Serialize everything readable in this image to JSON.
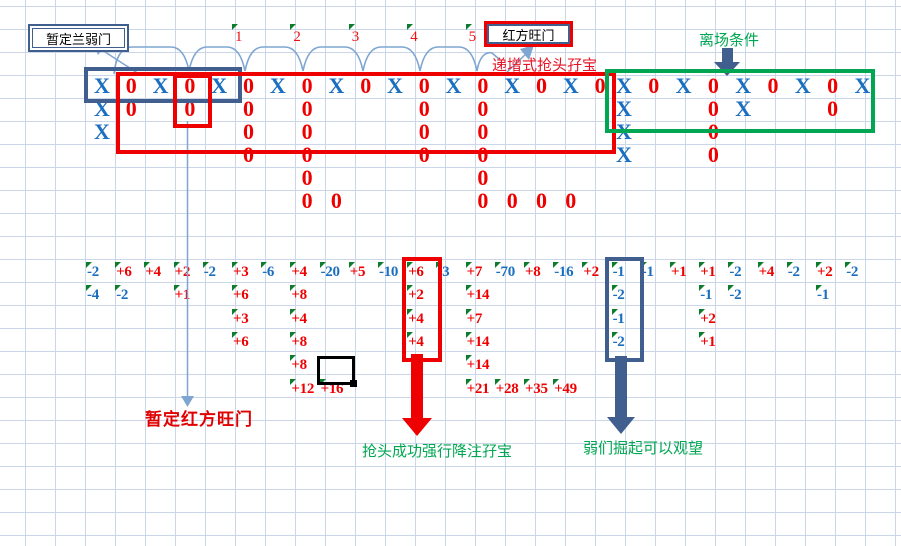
{
  "labels": {
    "weak_door": "暂定兰弱门",
    "strong_door": "红方旺门",
    "incremental_double": "递增式抢头孖宝",
    "exit_condition": "离场条件",
    "tentative_strong": "暂定红方旺门",
    "grab_success": "抢头成功强行降注孖宝",
    "weak_rise": "弱们掘起可以观望"
  },
  "header_numbers": [
    {
      "label": "1",
      "col": 5
    },
    {
      "label": "2",
      "col": 7
    },
    {
      "label": "3",
      "col": 9
    },
    {
      "label": "4",
      "col": 11
    },
    {
      "label": "5",
      "col": 13
    }
  ],
  "colors": {
    "x_blue": "#1b6fc0",
    "o_red": "#ef0000",
    "positive_red": "#ef0000",
    "negative_blue": "#1b6fc0",
    "navy_shape": "#415f8e",
    "green_shape": "#00a651",
    "comment_triangle_green": "#0d7d2d",
    "annotation_dark_red": "#e00000",
    "grid_line": "#cbd6e8",
    "thin_line_blue": "#7fa5d1",
    "box_red": "#ef0000",
    "selection_black": "#000000"
  },
  "left_grid_marks": [
    [
      0,
      0,
      "X"
    ],
    [
      0,
      1,
      "0"
    ],
    [
      0,
      2,
      "X"
    ],
    [
      0,
      3,
      "0"
    ],
    [
      0,
      4,
      "X"
    ],
    [
      0,
      5,
      "0"
    ],
    [
      0,
      6,
      "X"
    ],
    [
      0,
      7,
      "0"
    ],
    [
      0,
      8,
      "X"
    ],
    [
      0,
      9,
      "0"
    ],
    [
      0,
      10,
      "X"
    ],
    [
      0,
      11,
      "0"
    ],
    [
      0,
      12,
      "X"
    ],
    [
      0,
      13,
      "0"
    ],
    [
      0,
      14,
      "X"
    ],
    [
      0,
      15,
      "0"
    ],
    [
      0,
      16,
      "X"
    ],
    [
      0,
      17,
      "0"
    ],
    [
      1,
      0,
      "X"
    ],
    [
      1,
      1,
      "0"
    ],
    [
      1,
      3,
      "0"
    ],
    [
      1,
      5,
      "0"
    ],
    [
      1,
      7,
      "0"
    ],
    [
      1,
      11,
      "0"
    ],
    [
      1,
      13,
      "0"
    ],
    [
      2,
      0,
      "X"
    ],
    [
      2,
      5,
      "0"
    ],
    [
      2,
      7,
      "0"
    ],
    [
      2,
      11,
      "0"
    ],
    [
      2,
      13,
      "0"
    ],
    [
      3,
      5,
      "0"
    ],
    [
      3,
      7,
      "0"
    ],
    [
      3,
      11,
      "0"
    ],
    [
      3,
      13,
      "0"
    ],
    [
      4,
      7,
      "0"
    ],
    [
      4,
      13,
      "0"
    ],
    [
      5,
      7,
      "0"
    ],
    [
      5,
      8,
      "0"
    ],
    [
      5,
      13,
      "0"
    ],
    [
      5,
      14,
      "0"
    ],
    [
      5,
      15,
      "0"
    ],
    [
      5,
      16,
      "0"
    ]
  ],
  "right_grid_marks": [
    [
      0,
      0,
      "X"
    ],
    [
      0,
      1,
      "0"
    ],
    [
      0,
      2,
      "X"
    ],
    [
      0,
      3,
      "0"
    ],
    [
      0,
      4,
      "X"
    ],
    [
      0,
      5,
      "0"
    ],
    [
      0,
      6,
      "X"
    ],
    [
      0,
      7,
      "0"
    ],
    [
      0,
      8,
      "X"
    ],
    [
      1,
      0,
      "X"
    ],
    [
      1,
      3,
      "0"
    ],
    [
      1,
      4,
      "X"
    ],
    [
      1,
      7,
      "0"
    ],
    [
      2,
      0,
      "X"
    ],
    [
      2,
      3,
      "0"
    ],
    [
      3,
      0,
      "X"
    ],
    [
      3,
      3,
      "0"
    ]
  ],
  "number_cells": [
    [
      0,
      0,
      "-2"
    ],
    [
      0,
      1,
      "+6"
    ],
    [
      0,
      2,
      "+4"
    ],
    [
      0,
      3,
      "+2"
    ],
    [
      0,
      4,
      "-2"
    ],
    [
      0,
      5,
      "+3"
    ],
    [
      0,
      6,
      "-6"
    ],
    [
      0,
      7,
      "+4"
    ],
    [
      0,
      8,
      "-20"
    ],
    [
      0,
      9,
      "+5"
    ],
    [
      0,
      10,
      "-10"
    ],
    [
      0,
      11,
      "+6"
    ],
    [
      0,
      12,
      "-3"
    ],
    [
      0,
      13,
      "+7"
    ],
    [
      0,
      14,
      "-70"
    ],
    [
      0,
      15,
      "+8"
    ],
    [
      0,
      16,
      "-16"
    ],
    [
      0,
      17,
      "+2"
    ],
    [
      0,
      18,
      "-1"
    ],
    [
      0,
      19,
      "-1"
    ],
    [
      0,
      20,
      "+1"
    ],
    [
      0,
      21,
      "+1"
    ],
    [
      0,
      22,
      "-2"
    ],
    [
      0,
      23,
      "+4"
    ],
    [
      0,
      24,
      "-2"
    ],
    [
      0,
      25,
      "+2"
    ],
    [
      0,
      26,
      "-2"
    ],
    [
      1,
      0,
      "-4"
    ],
    [
      1,
      1,
      "-2"
    ],
    [
      1,
      3,
      "+1"
    ],
    [
      1,
      5,
      "+6"
    ],
    [
      1,
      7,
      "+8"
    ],
    [
      1,
      11,
      "+2"
    ],
    [
      1,
      13,
      "+14"
    ],
    [
      1,
      18,
      "-2"
    ],
    [
      1,
      21,
      "-1"
    ],
    [
      1,
      22,
      "-2"
    ],
    [
      1,
      25,
      "-1"
    ],
    [
      2,
      5,
      "+3"
    ],
    [
      2,
      7,
      "+4"
    ],
    [
      2,
      11,
      "+4"
    ],
    [
      2,
      13,
      "+7"
    ],
    [
      2,
      18,
      "-1"
    ],
    [
      2,
      21,
      "+2"
    ],
    [
      3,
      5,
      "+6"
    ],
    [
      3,
      7,
      "+8"
    ],
    [
      3,
      11,
      "+4"
    ],
    [
      3,
      13,
      "+14"
    ],
    [
      3,
      18,
      "-2"
    ],
    [
      3,
      21,
      "+1"
    ],
    [
      4,
      7,
      "+8"
    ],
    [
      4,
      13,
      "+14"
    ],
    [
      5,
      7,
      "+12"
    ],
    [
      5,
      8,
      "+16"
    ],
    [
      5,
      13,
      "+21"
    ],
    [
      5,
      14,
      "+28"
    ],
    [
      5,
      15,
      "+35"
    ],
    [
      5,
      16,
      "+49"
    ]
  ]
}
